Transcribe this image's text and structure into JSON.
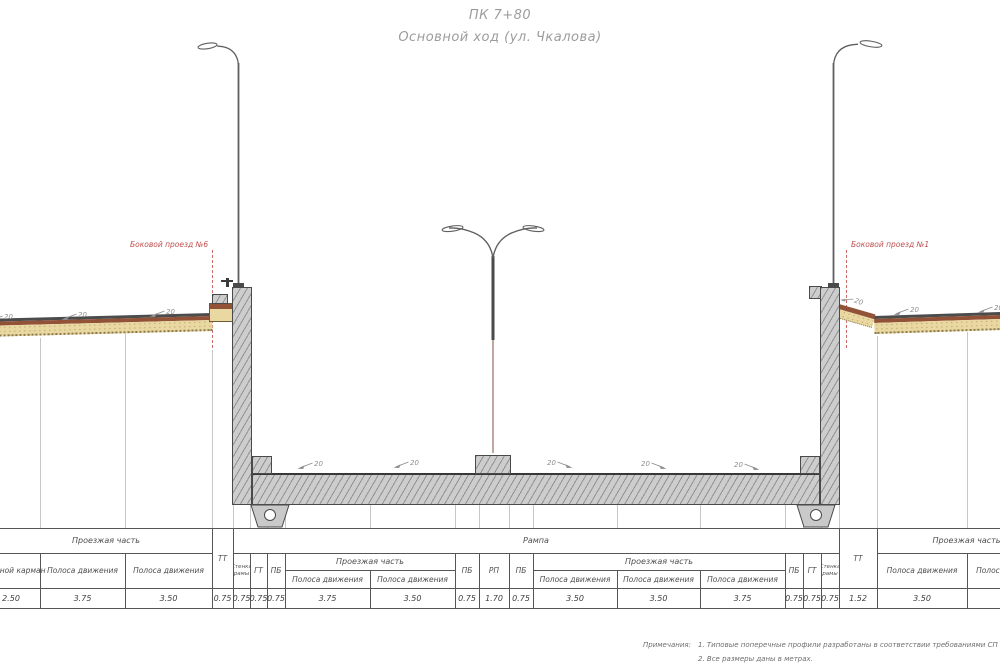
{
  "title": {
    "station": "ПК 7+80",
    "subtitle": "Основной ход (ул. Чкалова)"
  },
  "section_lines": {
    "left_label": "Боковой проезд №6",
    "right_label": "Боковой проезд №1"
  },
  "slope": {
    "value": "20"
  },
  "table": {
    "groups": {
      "left": "Проезжая часть",
      "ramp": "Рампа",
      "right": "Проезжая часть",
      "sub_left": "Проезжая часть",
      "sub_right": "Проезжая часть"
    },
    "columns": [
      {
        "label": "Заездной карман",
        "value": "2.50"
      },
      {
        "label": "Полоса движения",
        "value": "3.75"
      },
      {
        "label": "Полоса движения",
        "value": "3.50"
      },
      {
        "label": "ТТ",
        "value": "0.75"
      },
      {
        "label": "Стенка рамы",
        "value": "0.75"
      },
      {
        "label": "ГТ",
        "value": "0.75"
      },
      {
        "label": "ПБ",
        "value": "0.75"
      },
      {
        "label": "Полоса движения",
        "value": "3.75"
      },
      {
        "label": "Полоса движения",
        "value": "3.50"
      },
      {
        "label": "ПБ",
        "value": "0.75"
      },
      {
        "label": "РП",
        "value": "1.70"
      },
      {
        "label": "ПБ",
        "value": "0.75"
      },
      {
        "label": "Полоса движения",
        "value": "3.50"
      },
      {
        "label": "Полоса движения",
        "value": "3.50"
      },
      {
        "label": "Полоса движения",
        "value": "3.75"
      },
      {
        "label": "ПБ",
        "value": "0.75"
      },
      {
        "label": "ГТ",
        "value": "0.75"
      },
      {
        "label": "Стенка рамы",
        "value": "0.75"
      },
      {
        "label": "ТТ",
        "value": "1.52"
      },
      {
        "label": "Полоса движения",
        "value": "3.50"
      },
      {
        "label": "Полоса движения",
        "value": ""
      }
    ]
  },
  "notes": {
    "heading": "Примечания:",
    "items": [
      "1. Типовые поперечные профили разработаны в соответствии требованиями СП 42.13330.20",
      "2. Все размеры даны в метрах."
    ]
  },
  "colors": {
    "accent_red": "#c05050",
    "concrete_gray": "#cdcdcd",
    "asphalt": "#4c4c4c",
    "binder_brown": "#915238",
    "base_tan": "#e9d8a2"
  }
}
